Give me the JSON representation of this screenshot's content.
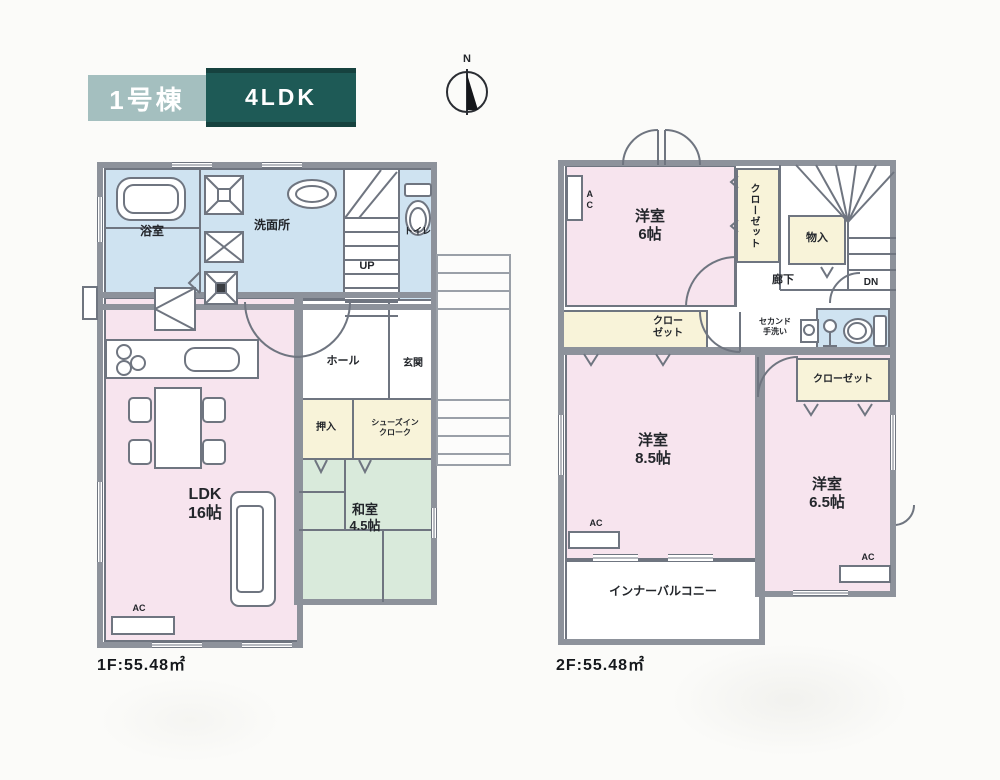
{
  "header": {
    "unit_badge": "1号棟",
    "plan_badge": "4LDK",
    "compass_n": "N"
  },
  "shared": {
    "ac_label": "AC"
  },
  "floor1": {
    "area_label": "1F:55.48㎡",
    "bath": "浴室",
    "washroom": "洗面所",
    "toilet": "トイレ",
    "stairs_up": "UP",
    "hall": "ホール",
    "entrance": "玄関",
    "oshiire": "押入",
    "shoes_cloak_line1": "シューズイン",
    "shoes_cloak_line2": "クローク",
    "ldk_name": "LDK",
    "ldk_size": "16帖",
    "washitsu_name": "和室",
    "washitsu_size": "4.5帖"
  },
  "floor2": {
    "area_label": "2F:55.48㎡",
    "bed6_name": "洋室",
    "bed6_size": "6帖",
    "closet_north": "クローゼット",
    "storage": "物入",
    "stairs_down": "DN",
    "hallway": "廊下",
    "second_sink_line1": "セカンド",
    "second_sink_line2": "手洗い",
    "closet_main_line1": "クロー",
    "closet_main_line2": "ゼット",
    "closet_east": "クローゼット",
    "bed85_name": "洋室",
    "bed85_size": "8.5帖",
    "bed65_name": "洋室",
    "bed65_size": "6.5帖",
    "balcony": "インナーバルコニー"
  },
  "colors": {
    "wall": "#8d929b",
    "line": "#6f7580",
    "ink": "#23262b",
    "pink": "#f7e4ee",
    "blue": "#cfe3f1",
    "cream": "#f8f3d9",
    "green": "#d9eadb",
    "badge_light": "#a4bfbf",
    "badge_dark": "#1e5a56",
    "paper": "#fbfbf9"
  }
}
